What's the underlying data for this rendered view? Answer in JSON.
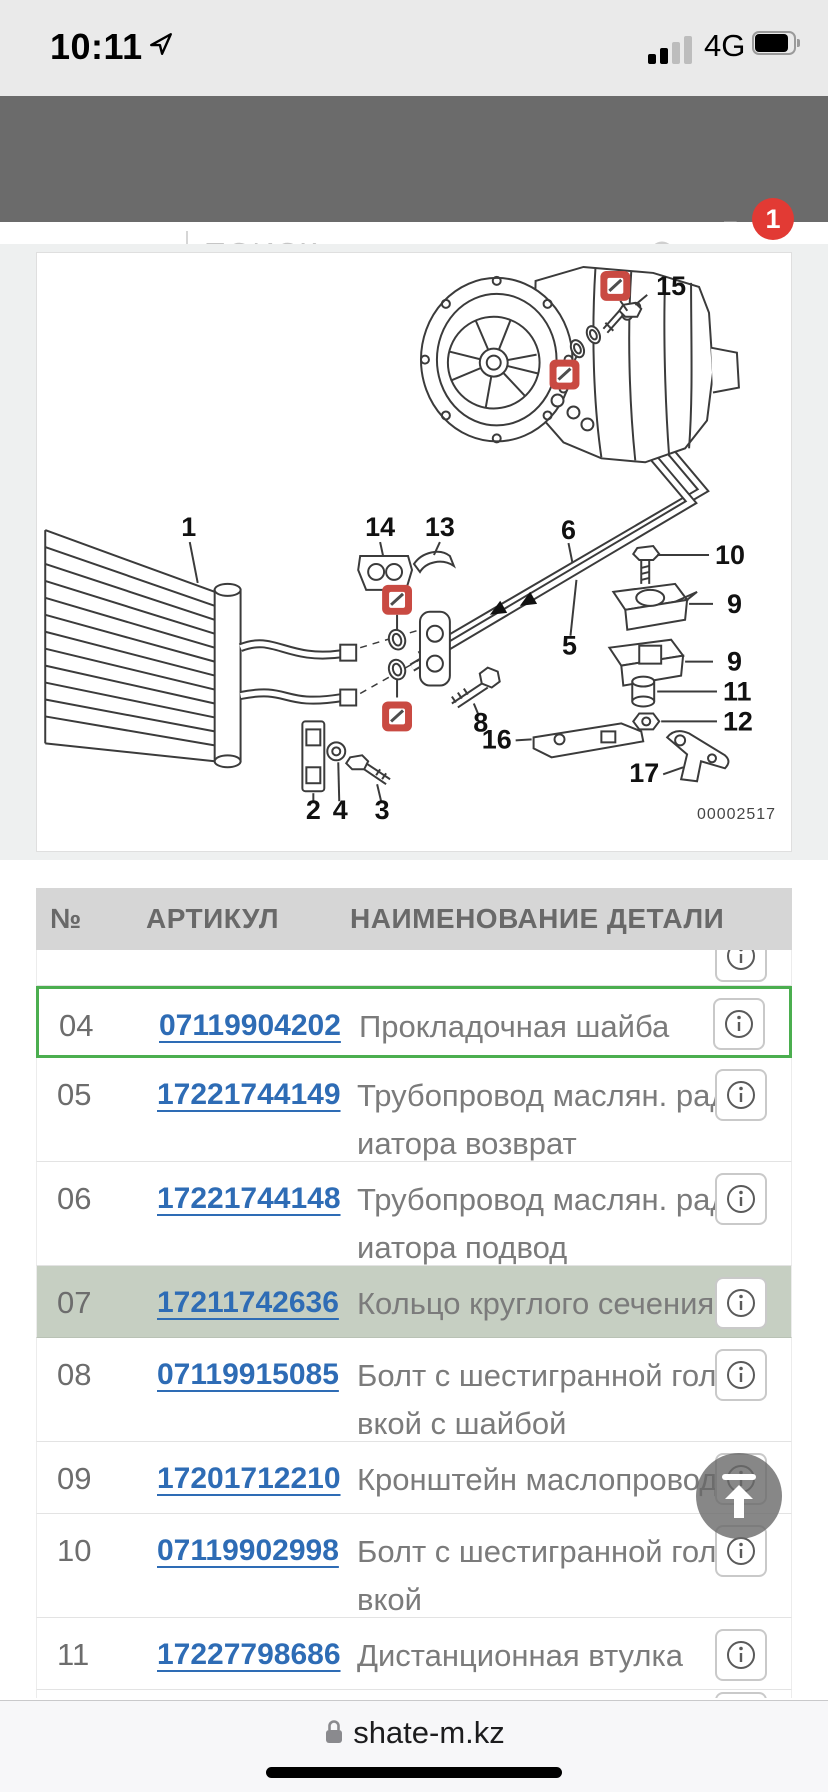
{
  "status_bar": {
    "time": "10:11",
    "network": "4G"
  },
  "header": {
    "search_placeholder": "ПОИСК",
    "cart_badge": "1"
  },
  "diagram": {
    "code": "00002517",
    "callouts": [
      {
        "n": "1"
      },
      {
        "n": "2"
      },
      {
        "n": "3"
      },
      {
        "n": "4"
      },
      {
        "n": "5"
      },
      {
        "n": "6"
      },
      {
        "n": "8"
      },
      {
        "n": "9"
      },
      {
        "n": "9"
      },
      {
        "n": "10"
      },
      {
        "n": "11"
      },
      {
        "n": "12"
      },
      {
        "n": "13"
      },
      {
        "n": "14"
      },
      {
        "n": "15"
      },
      {
        "n": "16"
      },
      {
        "n": "17"
      }
    ]
  },
  "table": {
    "headers": {
      "num": "№",
      "article": "АРТИКУЛ",
      "name": "НАИМЕНОВАНИЕ ДЕТАЛИ"
    },
    "rows": [
      {
        "num": "04",
        "article": "07119904202",
        "line1": "Прокладочная шайба"
      },
      {
        "num": "05",
        "article": "17221744149",
        "line1": "Трубопровод маслян. рад",
        "line2": "иатора возврат"
      },
      {
        "num": "06",
        "article": "17221744148",
        "line1": "Трубопровод маслян. рад",
        "line2": "иатора подвод"
      },
      {
        "num": "07",
        "article": "17211742636",
        "line1": "Кольцо круглого сечения"
      },
      {
        "num": "08",
        "article": "07119915085",
        "line1": "Болт с шестигранной голо",
        "line2": "вкой с шайбой"
      },
      {
        "num": "09",
        "article": "17201712210",
        "line1": "Кронштейн маслопровода"
      },
      {
        "num": "10",
        "article": "07119902998",
        "line1": "Болт с шестигранной голо",
        "line2": "вкой"
      },
      {
        "num": "11",
        "article": "17227798686",
        "line1": "Дистанционная втулка"
      }
    ]
  },
  "browser_bar": {
    "url": "shate-m.kz"
  },
  "colors": {
    "header_gray": "#6b6b6b",
    "table_header_gray": "#d6d6d6",
    "selected_row_border_green": "#4bae4f",
    "highlight_row_green": "#c6cfc2",
    "link_blue": "#2e6cb5",
    "badge_red": "#e23a34",
    "marker_red": "#c94a42"
  }
}
